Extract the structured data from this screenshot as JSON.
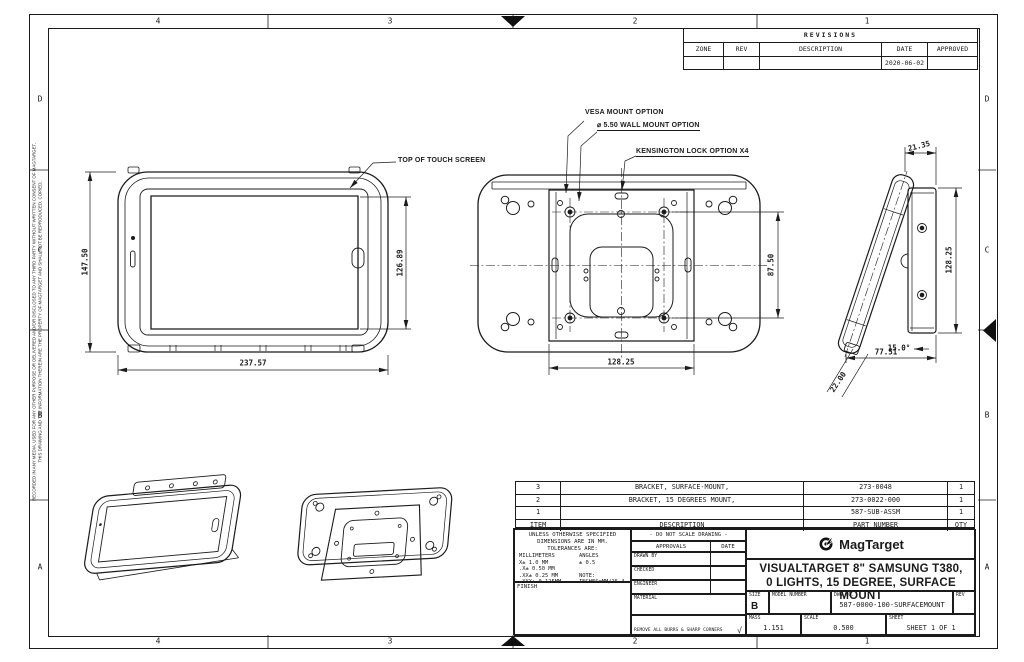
{
  "zones": {
    "cols": [
      "4",
      "3",
      "2",
      "1"
    ],
    "rows": [
      "D",
      "C",
      "B",
      "A"
    ]
  },
  "copyright": {
    "line1": "THIS DRAWING AND THE INFORMATION THEREIN ARE THE PROPERTY OF MAGTARGET AND SHALL NOT BE REPRODUCED, COPIED,",
    "line2": "RECORDED IN ANY MEDIA, USED FOR ANY OTHER PURPOSE OR DELIVERED AND/OR DISCLOSED TO ANY THIRD PARTY WITHOUT WRITTEN CONSENT OF MAGTARGET."
  },
  "revisions": {
    "title": "REVISIONS",
    "headers": [
      "ZONE",
      "REV",
      "DESCRIPTION",
      "DATE",
      "APPROVED"
    ],
    "entry": {
      "zone": "",
      "rev": "",
      "description": "",
      "date": "2020-06-02",
      "approved": ""
    }
  },
  "callouts": {
    "touch": "TOP OF TOUCH SCREEN",
    "vesa": "VESA MOUNT OPTION",
    "wall": "⌀ 5.50  WALL MOUNT OPTION",
    "kensington": "KENSINGTON LOCK OPTION X4"
  },
  "dims": {
    "front_height": "147.50",
    "front_width": "237.57",
    "screen_height": "126.89",
    "hole_spacing": "87.50",
    "plate_width": "128.25",
    "side_offset": "21.35",
    "plate_height": "128.25",
    "tilt_angle": "15.0°",
    "base_depth": "77.51",
    "thickness": "22.00"
  },
  "parts": {
    "headers": [
      "ITEM",
      "DESCRIPTION",
      "PART NUMBER",
      "QTY"
    ],
    "rows": [
      {
        "item": "3",
        "description": "BRACKET, SURFACE-MOUNT,",
        "part_number": "273-0048",
        "qty": "1"
      },
      {
        "item": "2",
        "description": "BRACKET, 15 DEGREES MOUNT,",
        "part_number": "273-0022-000",
        "qty": "1"
      },
      {
        "item": "1",
        "description": "",
        "part_number": "587-SUB-ASSM",
        "qty": "1"
      }
    ]
  },
  "tolerances": {
    "h1": "UNLESS OTHERWISE SPECIFIED",
    "h2": "DIMENSIONS ARE IN MM.",
    "h3": "TOLERANCES ARE:",
    "rows": [
      [
        "MILLIMETERS",
        "ANGLES"
      ],
      [
        "X±  1.0  MM",
        "± 0.5"
      ],
      [
        ".X±  0.50 MM",
        ""
      ],
      [
        ".XX±  0.25 MM",
        "NOTE:"
      ],
      [
        ".XXX± 0.125MM",
        "INCHES=MM/25.4"
      ]
    ],
    "finish": "FINISH"
  },
  "approvals": {
    "do_not_scale": "- DO NOT SCALE DRAWING -",
    "approvals": "APPROVALS",
    "date": "DATE",
    "drawn_by": "DRAWN BY",
    "checked": "CHECKED",
    "engineer": "ENGINEER",
    "material": "MATERIAL",
    "burrs": "REMOVE ALL BURRS & SHARP CORNERS"
  },
  "title_block": {
    "brand": "MagTarget",
    "title1": "VISUALTARGET 8\" SAMSUNG T380,",
    "title2": "0 LIGHTS, 15 DEGREE, SURFACE MOUNT",
    "size_label": "SIZE",
    "size": "B",
    "model_label": "MODEL NUMBER",
    "model": "",
    "dwg_label": "DWG NO.",
    "dwg_no": "587-0000-100-SURFACEMOUNT",
    "rev_label": "REV",
    "rev": "",
    "mass_label": "MASS",
    "mass": "1.151",
    "scale_label": "SCALE",
    "scale": "0.500",
    "sheet_label": "SHEET",
    "sheet": "SHEET 1 OF 1"
  }
}
